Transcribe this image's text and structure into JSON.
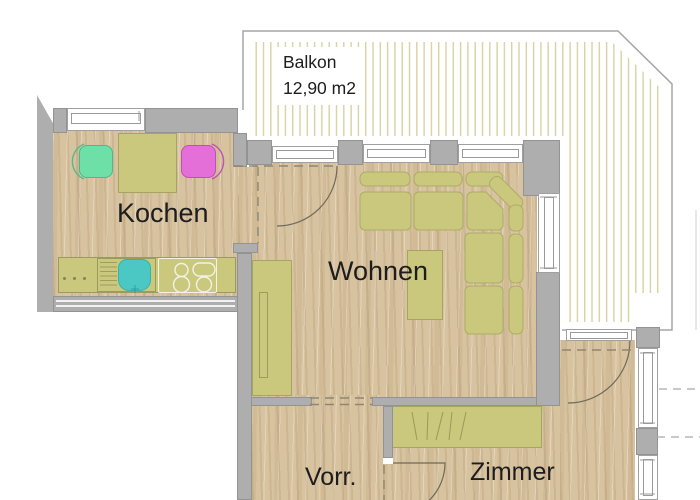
{
  "labels": {
    "kochen": "Kochen",
    "wohnen": "Wohnen",
    "vorr": "Vorr.",
    "zimmer": "Zimmer",
    "balkon": "Balkon",
    "balkon_area": "12,90 m2"
  },
  "colors": {
    "floor-wood": "#d8c3a0",
    "wall-gray": "#aeaeae",
    "furniture-olive": "#c9c87d",
    "furniture-border": "#a6a55f",
    "sink-teal": "#4cc8c4",
    "chair-green": "#6fdfa8",
    "chair-magenta": "#e56fd8",
    "hatch-stripe": "#d9d2a2",
    "outline-gray": "#a5a5a5",
    "label-text": "#1d1d1d"
  }
}
